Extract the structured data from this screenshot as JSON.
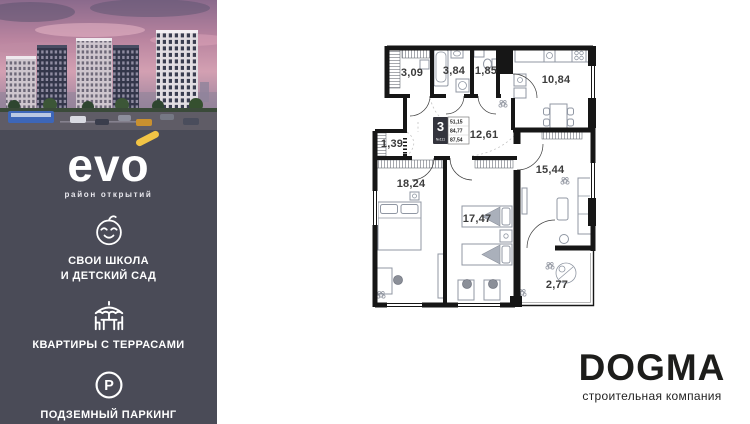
{
  "colors": {
    "sidebar_bg": "#4a4b57",
    "accent_yellow": "#f2c445",
    "wall": "#161616",
    "brand_text": "#1d1d1b"
  },
  "sidebar": {
    "logo": {
      "text": "evo",
      "tagline": "район открытий"
    },
    "features": [
      {
        "icon": "baby-icon",
        "lines": [
          "СВОИ ШКОЛА",
          "И ДЕТСКИЙ САД"
        ]
      },
      {
        "icon": "terrace-icon",
        "lines": [
          "КВАРТИРЫ С ТЕРРАСАМИ"
        ]
      },
      {
        "icon": "parking-icon",
        "lines": [
          "ПОДЗЕМНЫЙ ПАРКИНГ"
        ]
      }
    ]
  },
  "floorplan": {
    "badge": {
      "rooms": "3",
      "apartment_number": "№111",
      "living_area": "51,15",
      "area_without_terrace": "84,77",
      "total_area": "87,54"
    },
    "rooms": [
      {
        "name": "hallway",
        "area": "3,09"
      },
      {
        "name": "bathroom",
        "area": "3,84"
      },
      {
        "name": "wc",
        "area": "1,85"
      },
      {
        "name": "kitchen",
        "area": "10,84"
      },
      {
        "name": "corridor",
        "area": "12,61"
      },
      {
        "name": "storage",
        "area": "1,39"
      },
      {
        "name": "bedroom",
        "area": "18,24"
      },
      {
        "name": "living-room",
        "area": "15,44"
      },
      {
        "name": "children-room",
        "area": "17,47"
      },
      {
        "name": "terrace",
        "area": "2,77"
      }
    ]
  },
  "brand": {
    "name": "DOGMA",
    "tagline": "строительная компания"
  }
}
